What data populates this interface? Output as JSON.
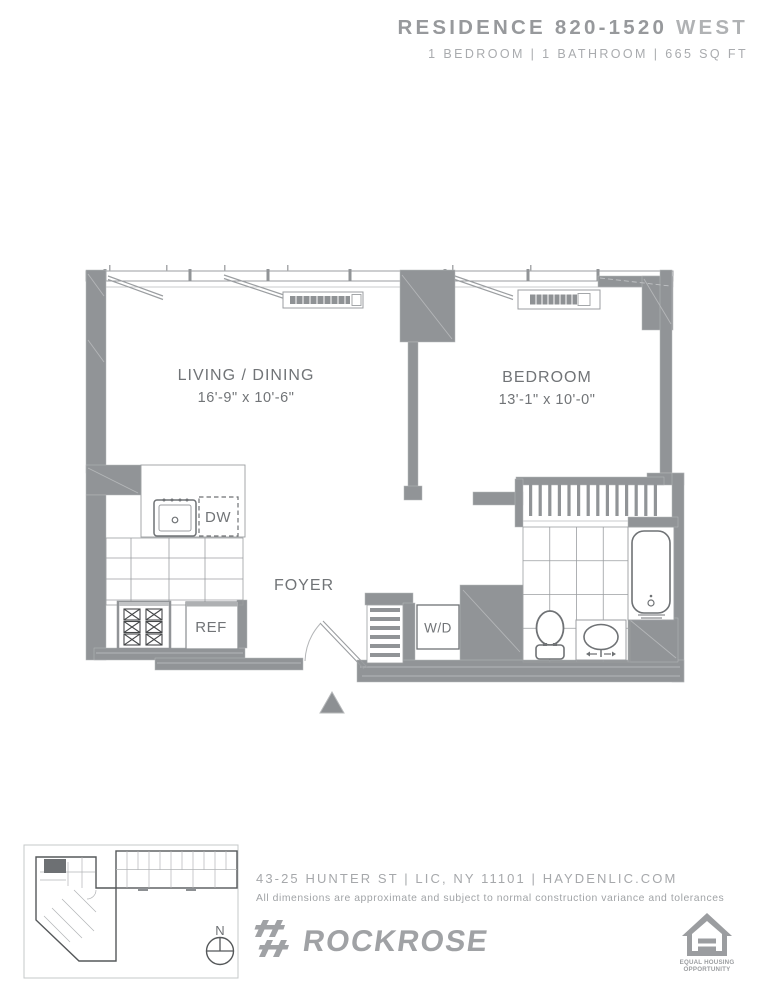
{
  "header": {
    "residence": "RESIDENCE 820-1520",
    "tower": "WEST",
    "specs": "1 BEDROOM | 1 BATHROOM | 665 SQ FT"
  },
  "floorplan": {
    "living": {
      "name": "LIVING / DINING",
      "dims": "16'-9\" x 10'-6\""
    },
    "bedroom": {
      "name": "BEDROOM",
      "dims": "13'-1\" x 10'-0\""
    },
    "foyer": {
      "name": "FOYER"
    },
    "appliances": {
      "dishwasher": "DW",
      "refrigerator": "REF",
      "washer_dryer": "W/D"
    }
  },
  "keymap": {
    "compass": "N"
  },
  "footer": {
    "address": "43-25 HUNTER ST | LIC, NY 11101 | HAYDENLIC.COM",
    "disclaimer": "All dimensions are approximate and subject to normal construction variance and tolerances",
    "brand": "ROCKROSE",
    "eho_line1": "EQUAL HOUSING",
    "eho_line2": "OPPORTUNITY"
  },
  "colors": {
    "wall": "#919497",
    "fixture_line": "#9b9ea1",
    "dark_line": "#6f7275",
    "label_text": "#717477",
    "brand_gray": "#a0a2a5"
  }
}
